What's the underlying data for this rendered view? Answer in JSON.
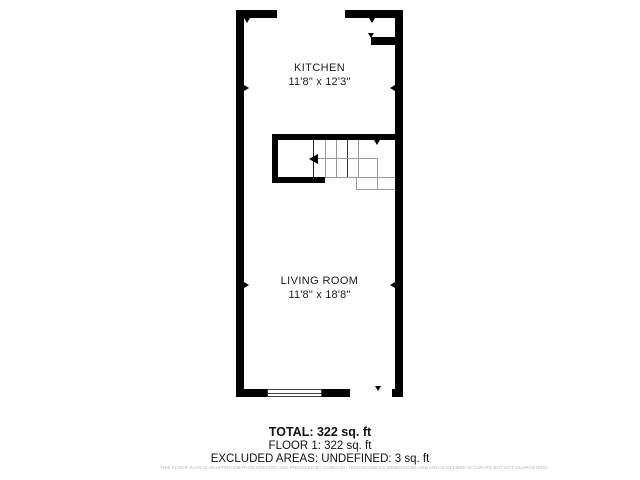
{
  "plan": {
    "rooms": [
      {
        "name": "KITCHEN",
        "dimensions": "11'8\" x 12'3\""
      },
      {
        "name": "LIVING ROOM",
        "dimensions": "11'8\" x 18'8\""
      }
    ],
    "colors": {
      "wall": "#000000",
      "stair_outline": "#9a9a9a",
      "text": "#1c1c1c",
      "disclaimer_text": "#b8b8b8",
      "background": "#ffffff"
    }
  },
  "summary": {
    "total_label": "TOTAL: 322 sq. ft",
    "floor_label": "FLOOR 1: 322 sq. ft",
    "excluded_label": "EXCLUDED AREAS: UNDEFINED: 3 sq. ft",
    "disclaimer": "THIS FLOOR PLAN IS AN APPROXIMATION CREATED AND PROVIDED BY CUBICASA TECHNOLOGIES. DIMENSIONS AND AREAS DEEMED ACCURATE BUT NOT GUARANTEED."
  }
}
